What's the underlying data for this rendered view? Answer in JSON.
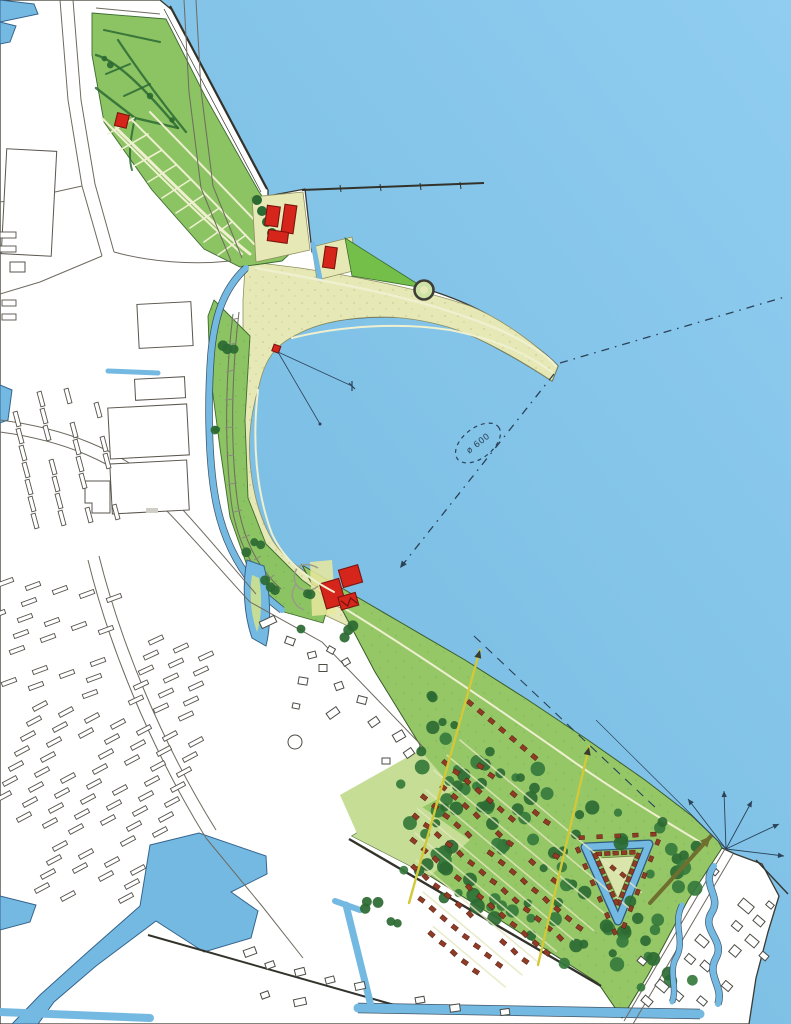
{
  "annotation": {
    "label": "ø 600"
  },
  "colors": {
    "sea": "#7fc2e6",
    "seaLight": "#90cdf0",
    "seaDeep": "#6fb5dd",
    "land": "#ffffff",
    "sand": "#e6e9b6",
    "greenMid": "#8cc363",
    "greenBright": "#74bf4a",
    "greenWood": "#95c767",
    "greenPale": "#c6dd96",
    "treeDark": "#2c6a33",
    "houseRed": "#8f3c26",
    "buildingRed": "#d6261c",
    "canal": "#74b9e2",
    "outline": "#3a3a33",
    "ink": "#2c4257",
    "arrowYellow": "#d2c838",
    "arrowOlive": "#6f7030"
  }
}
